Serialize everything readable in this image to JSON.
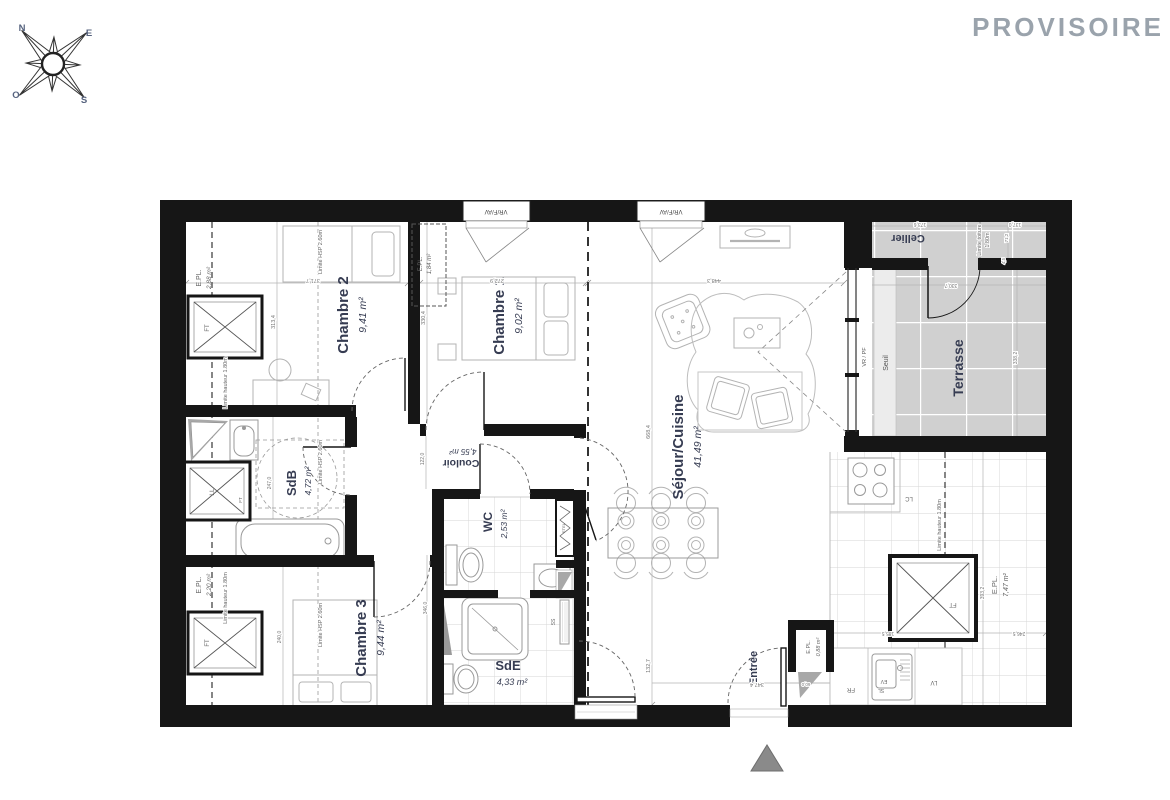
{
  "title": {
    "provisoire": "PROVISOIRE"
  },
  "compass": {
    "n": "N",
    "e": "E",
    "s": "S",
    "o": "O"
  },
  "rooms": {
    "chambre2": {
      "name": "Chambre 2",
      "area": "9,41 m²"
    },
    "chambre1": {
      "name": "Chambre 1",
      "area": "9,02 m²"
    },
    "chambre3": {
      "name": "Chambre 3",
      "area": "9,44 m²"
    },
    "sejour": {
      "name": "Séjour/Cuisine",
      "area": "41,49 m²"
    },
    "sdb": {
      "name": "SdB",
      "area": "4,72 m²"
    },
    "couloir": {
      "name": "Couloir",
      "area": "4,55 m²"
    },
    "wc": {
      "name": "WC",
      "area": "2,53 m²"
    },
    "sde": {
      "name": "SdE",
      "area": "4,33 m²"
    },
    "cellier": {
      "name": "Cellier"
    },
    "terrasse": {
      "name": "Terrasse"
    },
    "entree": {
      "name": "Entrée"
    }
  },
  "closets": {
    "epl": "E.PL.",
    "a288": "2,88 m²",
    "a184": "1,84 m²",
    "a220": "2,20 m²",
    "a088": "0,88 m²",
    "a747": "7,47 m²"
  },
  "fixtures": {
    "ft": "FT",
    "ll": "LL",
    "lc": "LC",
    "fr": "FR",
    "ev": "EV",
    "sl": "SL",
    "lv": "LV",
    "ss": "SS",
    "etel": "ETEL"
  },
  "openings": {
    "window": "VR/F/AV",
    "slider": "VR / PF",
    "seuil": "Seuil"
  },
  "limits": {
    "hauteur": "Limite hauteur 1.80m",
    "hsp": "Limite HSP 2.60m",
    "toiture1": "Limite toiture",
    "toiture2": "1.80m"
  },
  "dims": {
    "d3717": "371,7",
    "d3134": "313,4",
    "d3304": "330,4",
    "d2729": "272,9",
    "d4483": "448,3",
    "d6684": "668,4",
    "d1327": "132,7",
    "d3474": "347,4",
    "d2470": "247,0",
    "d1220": "122,0",
    "d3460": "346,0",
    "d2400": "240,0",
    "d1855": "185,5",
    "d2465": "246,5",
    "d3932": "393,2",
    "d1736": "173,6",
    "d1370": "137,0",
    "d712": "71,2",
    "d45": "4,5",
    "d3307": "330,7",
    "d3382": "338,2",
    "d600": "60,0"
  }
}
